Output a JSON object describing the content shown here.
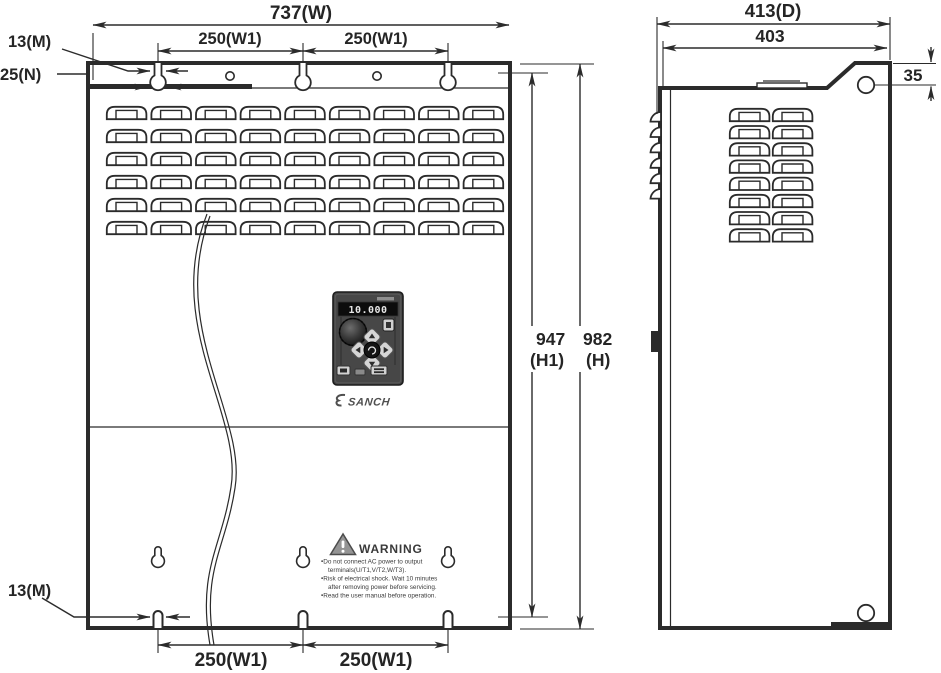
{
  "drawing": {
    "dimensions": {
      "width_total": "737(W)",
      "hole_spacing": "250(W1)",
      "hole_width": "13(M)",
      "bracket_overlap": "25(N)",
      "height_body_value": "947",
      "height_body_label": "(H1)",
      "height_total_value": "982",
      "height_total_label": "(H)",
      "depth_total": "413(D)",
      "depth_body": "403",
      "bracket_hole_offset": "35"
    },
    "device": {
      "brand": "SANCH",
      "keypad_display": "10.000"
    },
    "warning_label": {
      "icon": "warning-triangle-icon",
      "title": "WARNING",
      "lines": [
        "•Do not connect AC power to output",
        "terminals(U/T1,V/T2,W/T3).",
        "•Risk of electrical shock. Wait 10 minutes",
        "after removing power before servicing.",
        "•Read the user manual before operation."
      ]
    },
    "colors": {
      "line": "#2b2b2b",
      "background": "#ffffff",
      "keypad_body": "#474747"
    }
  }
}
